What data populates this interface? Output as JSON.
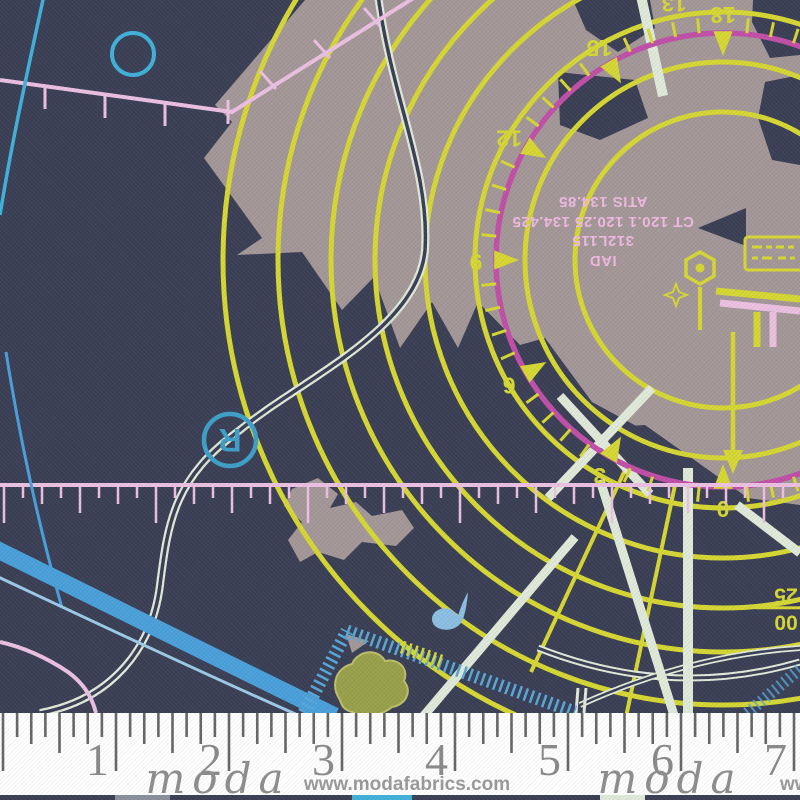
{
  "colors": {
    "background": "#3a3f55",
    "land": "#a49798",
    "yellow": "#d6d733",
    "magenta": "#c14fa8",
    "pink_line": "#ecc0e2",
    "pink_text": "#efb9e2",
    "cyan": "#41b1d9",
    "blue_band": "#4aa0da",
    "blue_light": "#9ccae8",
    "mint": "#e0ead9",
    "olive": "#99a04b",
    "olive_edge": "#bcc06a",
    "hatch_blue": "#57a8d8",
    "bird_blue": "#8cbfe2",
    "r_blue": "#3f9fc9",
    "ruler_tick": "#666666",
    "ruler_number": "#8a8a8a",
    "logo_gray": "#8e8e8e",
    "website_gray": "#9a9a9a"
  },
  "radar": {
    "center": {
      "x": 723,
      "y": 260
    },
    "yellow_ring_radii": [
      148,
      198,
      248,
      298,
      348,
      392,
      445,
      500
    ],
    "compass_ring_radius": 227,
    "compass_labels": [
      {
        "deg": 90,
        "text": "0"
      },
      {
        "deg": 120,
        "text": "3"
      },
      {
        "deg": 150,
        "text": "6"
      },
      {
        "deg": 180,
        "text": "9"
      },
      {
        "deg": 210,
        "text": "12"
      },
      {
        "deg": 240,
        "text": "15"
      },
      {
        "deg": 270,
        "text": "18"
      }
    ],
    "tick_step_deg": 6,
    "tick_span_deg": [
      72,
      288
    ],
    "partial_top_label": "13"
  },
  "info_block": {
    "lines": [
      "IAD",
      "312L115",
      "CT 120.1 120.25 134.425",
      "ATIS 134.85"
    ]
  },
  "fraction_label": {
    "line1": "00",
    "line2": "25"
  },
  "r_marker": {
    "text": "R"
  },
  "ruler": {
    "numbers": [
      "1",
      "2",
      "3",
      "4",
      "5",
      "6",
      "7"
    ]
  },
  "branding": {
    "logo": "moda",
    "website": "www.modafabrics.com",
    "website_partial": "www.m"
  }
}
